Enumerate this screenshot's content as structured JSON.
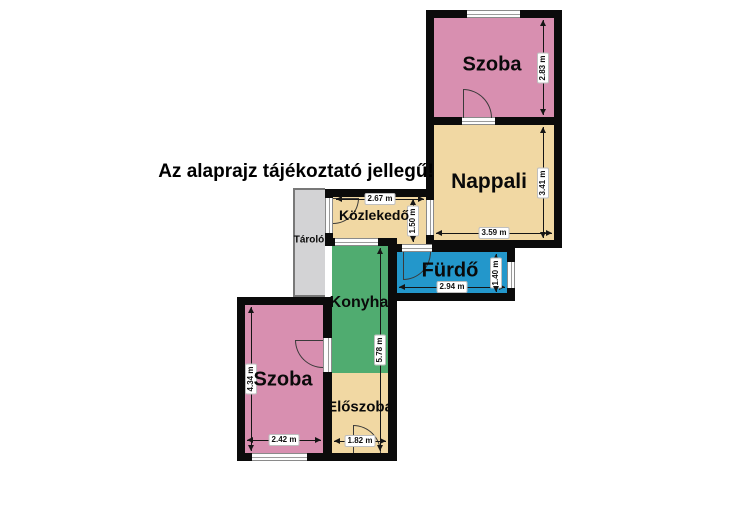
{
  "notice": "Az alaprajz tájékoztató jellegű!",
  "unit": "m",
  "colors": {
    "room_pink": "#d88fb0",
    "room_tan": "#f1d8a3",
    "room_green": "#50ac70",
    "room_blue": "#2397cb",
    "room_gray": "#d3d3d5",
    "wall": "#0b0b0b",
    "background": "#ffffff"
  },
  "rooms": {
    "szoba_top": {
      "label": "Szoba",
      "height_label": "2.83 m"
    },
    "nappali": {
      "label": "Nappali",
      "width_label": "3.59 m",
      "height_label": "3.41 m"
    },
    "kozlekedo": {
      "label": "Közlekedő",
      "width_label": "2.67 m",
      "height_label": "1.50 m"
    },
    "tarolo": {
      "label": "Tároló"
    },
    "furdo": {
      "label": "Fürdő",
      "width_label": "2.94 m",
      "height_label": "1.40 m"
    },
    "konyha": {
      "label": "Konyha",
      "height_label": "5.78 m"
    },
    "eloszoba": {
      "label": "Előszoba",
      "width_label": "1.82 m"
    },
    "szoba_bottom": {
      "label": "Szoba",
      "width_label": "2.42 m",
      "height_label": "4.34 m"
    }
  }
}
